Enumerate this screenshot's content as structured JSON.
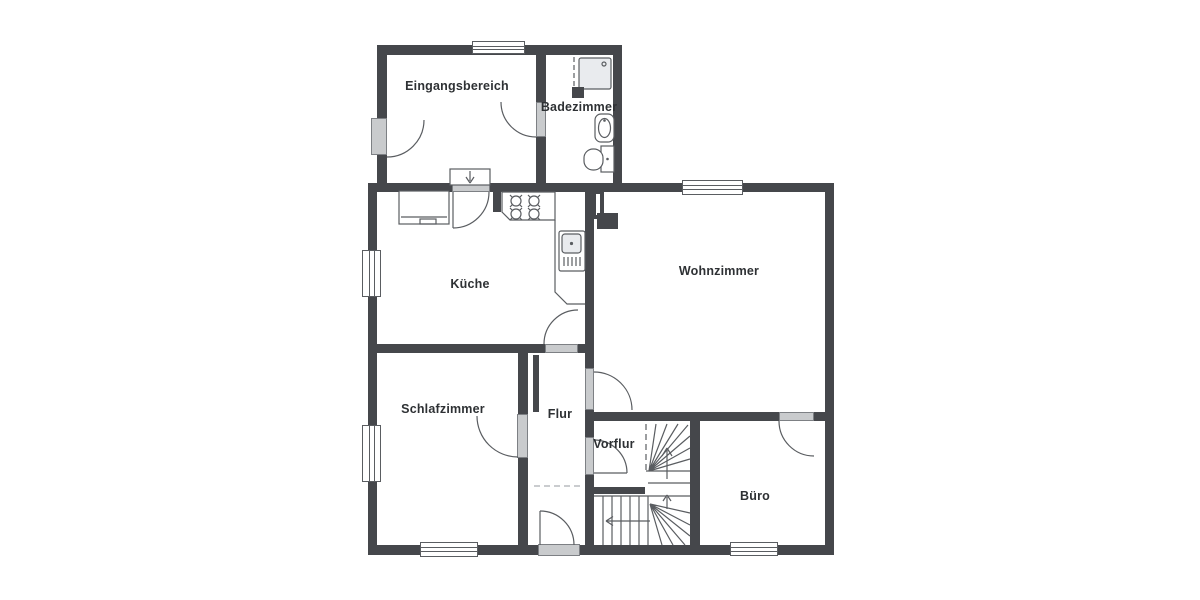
{
  "floorplan": {
    "type": "apartment-floor-plan",
    "rooms": [
      {
        "id": "eingangsbereich",
        "label": "Eingangsbereich"
      },
      {
        "id": "badezimmer",
        "label": "Badezimmer"
      },
      {
        "id": "kueche",
        "label": "Küche"
      },
      {
        "id": "wohnzimmer",
        "label": "Wohnzimmer"
      },
      {
        "id": "schlafzimmer",
        "label": "Schlafzimmer"
      },
      {
        "id": "flur",
        "label": "Flur"
      },
      {
        "id": "vorflur",
        "label": "Vorflur"
      },
      {
        "id": "buero",
        "label": "Büro"
      }
    ],
    "fixtures": [
      "shower",
      "washbasin",
      "toilet",
      "stove-4-burners",
      "kitchen-sink",
      "appliance",
      "entry-steps-arrow",
      "winder-staircase",
      "chimney"
    ],
    "door_count": 9,
    "window_count": 6,
    "colors": {
      "wall": "#45474b",
      "door_fill": "#c9cbcd",
      "line": "#5a5d61",
      "text": "#2e3134",
      "dashed_line": "#b9bcbf",
      "fixture_fill": "#e9ebee",
      "background": "#ffffff"
    }
  }
}
